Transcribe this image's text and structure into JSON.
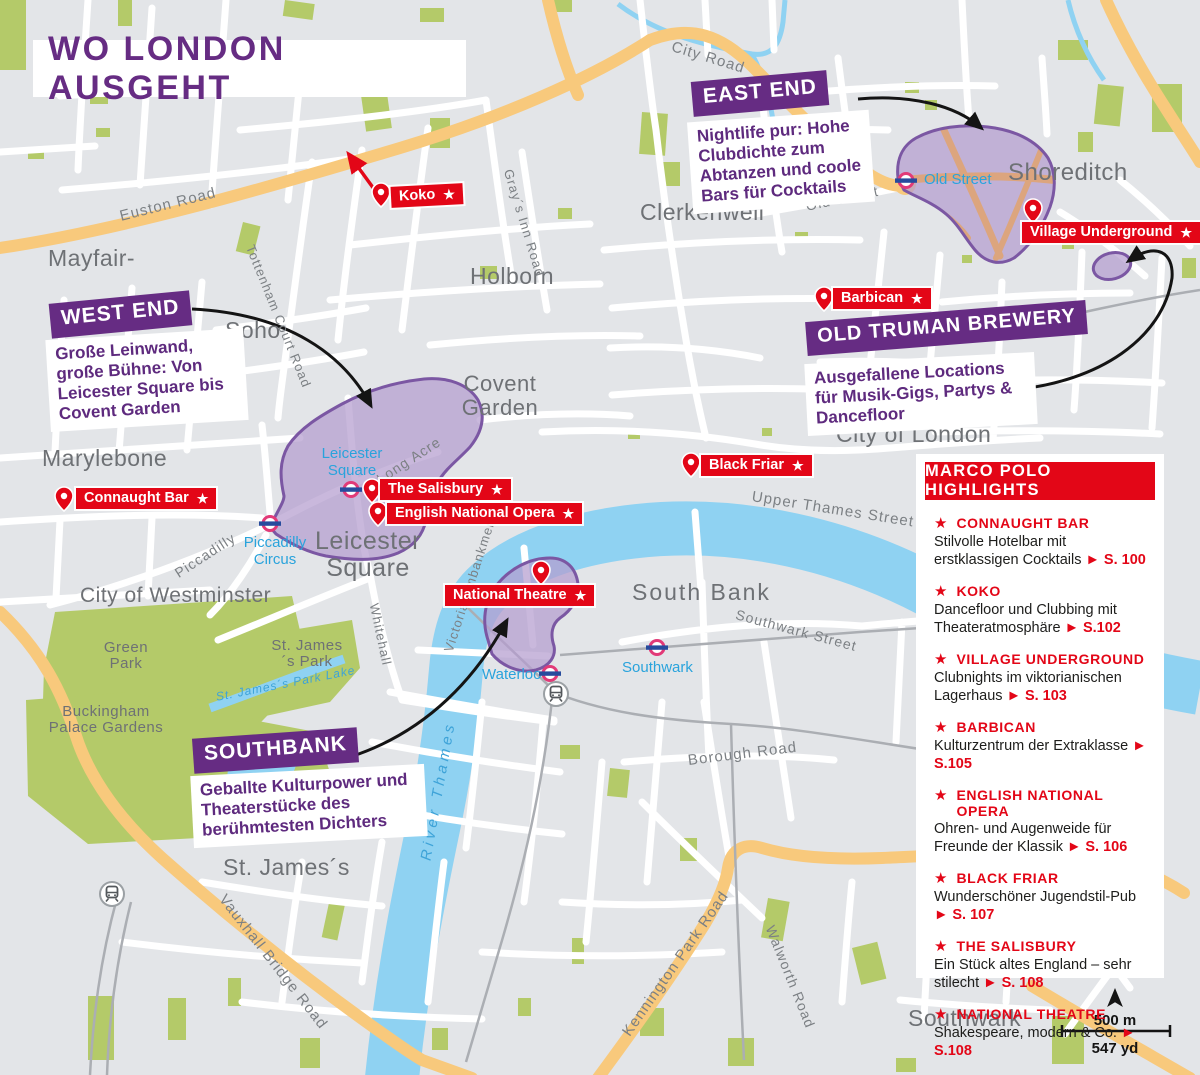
{
  "title": "WO LONDON AUSGEHT",
  "icons": {
    "star": "★",
    "page_arrow": "►"
  },
  "callouts": {
    "west_end": {
      "heading": "WEST END",
      "description": "Große Leinwand, große Bühne: Von Leicester Square bis Covent Garden"
    },
    "east_end": {
      "heading": "EAST END",
      "description": "Nightlife pur: Hohe Clubdichte zum Abtanzen und coole Bars für Cocktails"
    },
    "old_truman_brewery": {
      "heading": "OLD TRUMAN BREWERY",
      "description": "Ausgefallene Locations für Musik-Gigs, Partys & Dancefloor"
    },
    "southbank": {
      "heading": "SOUTHBANK",
      "description": "Geballte Kulturpower und Theaterstücke des berühmtesten Dichters"
    }
  },
  "highlights": {
    "title": "MARCO POLO HIGHLIGHTS",
    "items": [
      {
        "name": "CONNAUGHT BAR",
        "description": "Stilvolle Hotelbar mit erstklassigen Cocktails",
        "page": "S. 100"
      },
      {
        "name": "KOKO",
        "description": "Dancefloor und Clubbing mit Theateratmosphäre",
        "page": "S.102"
      },
      {
        "name": "VILLAGE UNDERGROUND",
        "description": "Clubnights im viktorianischen Lagerhaus",
        "page": "S. 103"
      },
      {
        "name": "BARBICAN",
        "description": "Kulturzentrum der Extraklasse",
        "page": "S.105"
      },
      {
        "name": "ENGLISH NATIONAL OPERA",
        "description": "Ohren- und Augenweide für Freunde der Klassik",
        "page": "S. 106"
      },
      {
        "name": "BLACK FRIAR",
        "description": "Wunderschöner Jugendstil-Pub",
        "page": "S. 107"
      },
      {
        "name": "THE SALISBURY",
        "description": "Ein Stück altes England – sehr stilecht",
        "page": "S. 108"
      },
      {
        "name": "NATIONAL THEATRE",
        "description": "Shakespeare, modern & Co.",
        "page": "S.108"
      }
    ]
  },
  "pins": [
    {
      "label": "Koko"
    },
    {
      "label": "Connaught Bar"
    },
    {
      "label": "The Salisbury"
    },
    {
      "label": "English National Opera"
    },
    {
      "label": "Black Friar"
    },
    {
      "label": "Barbican"
    },
    {
      "label": "Village Underground"
    },
    {
      "label": "National Theatre"
    }
  ],
  "tube_stations": [
    {
      "name": "Old Street"
    },
    {
      "name": "Leicester Square"
    },
    {
      "name": "Piccadilly Circus"
    },
    {
      "name": "Waterloo"
    },
    {
      "name": "Southwark"
    }
  ],
  "districts": [
    "Mayfair-",
    "Soho",
    "Holborn",
    "Clerkenwell",
    "Shoreditch",
    "Covent Garden",
    "City of London",
    "Marylebone",
    "City of Westminster",
    "South Bank",
    "Green Park",
    "Buckingham Palace Gardens",
    "St. James´s Park",
    "St. James´s",
    "Leicester Square",
    "Southwark"
  ],
  "roads": [
    "Euston Road",
    "City Road",
    "Gray´s Inn Road",
    "Old Street",
    "Tottenham Court Road",
    "Long Acre",
    "Piccadilly",
    "Whitehall",
    "Victoria Embankment",
    "Upper Thames Street",
    "Southwark Street",
    "Borough Road",
    "Vauxhall Bridge Road",
    "Kennington Park Road",
    "Walworth Road"
  ],
  "water_labels": [
    "River Thames",
    "St. James´s Park Lake"
  ],
  "scale": {
    "metric": "500 m",
    "imperial": "547 yd"
  },
  "colors": {
    "purple": "#662c83",
    "red": "#e30617",
    "tube_blue": "#29a3dc",
    "area_fill": "#b49cce",
    "area_stroke": "#7b57a3"
  }
}
